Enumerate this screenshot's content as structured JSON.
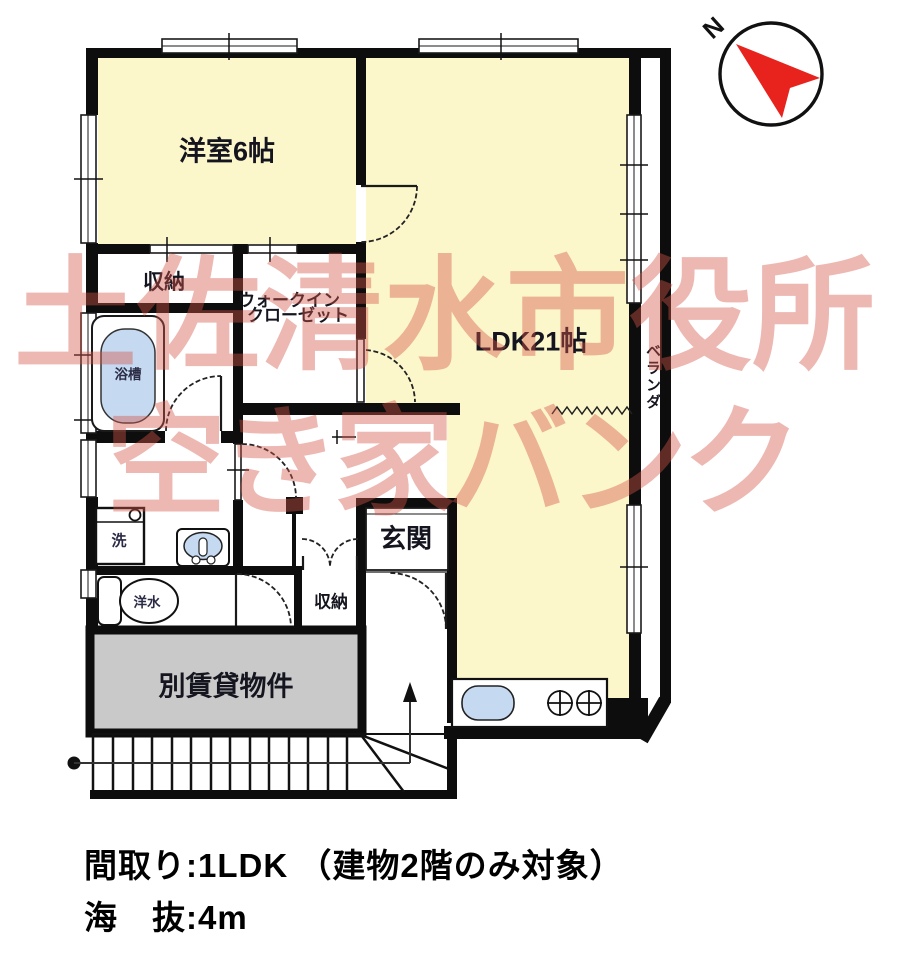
{
  "rooms": {
    "western_room": "洋室6帖",
    "ldk": "LDK21帖",
    "closet_top": "収納",
    "wic_line1": "ウォークイン",
    "wic_line2": "クローゼット",
    "bathtub": "浴槽",
    "washer": "洗",
    "toilet": "洋水",
    "closet_hall": "収納",
    "genkan": "玄関",
    "other_rental": "別賃貸物件",
    "veranda": "ベランダ"
  },
  "compass": {
    "north_label": "N"
  },
  "watermark": {
    "line1": "土佐清水市役所",
    "line2": "空き家バンク",
    "color": "#d5544a"
  },
  "caption": {
    "line1": "間取り:1LDK （建物2階のみ対象）",
    "line2": "海　抜:4m"
  },
  "colors": {
    "room_fill": "#fcf6cb",
    "fixture_fill": "#c5d9f1",
    "rental_fill": "#c9c9c9",
    "needle": "#e8231d",
    "wall": "#0d0d0d"
  }
}
